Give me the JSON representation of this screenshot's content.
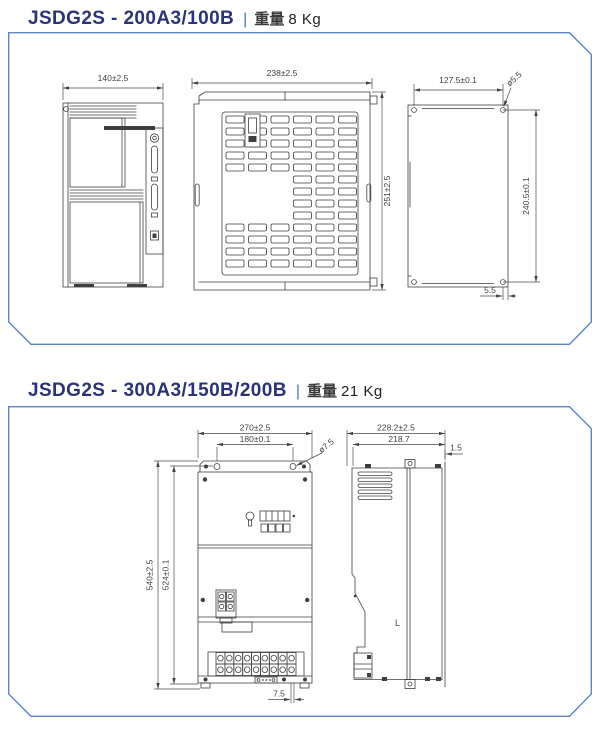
{
  "page": {
    "title_color": "#2b3377",
    "box_border_color": "#5b86c2",
    "line_color": "#3f3f3f"
  },
  "sections": [
    {
      "model": "JSDG2S - 200A3/100B",
      "separator": "|",
      "weight_label": "重量",
      "weight_value": "8 Kg",
      "dims": {
        "front_width": "140±2.5",
        "vent_width": "238±2.5",
        "vent_height": "251±2.5",
        "mount_width": "127.5±0.1",
        "mount_hole_dia": "ø5.5",
        "mount_height": "240.5±0.1",
        "mount_edge_offset": "5.5"
      }
    },
    {
      "model": "JSDG2S - 300A3/150B/200B",
      "separator": "|",
      "weight_label": "重量",
      "weight_value": "21 Kg",
      "dims": {
        "front_width": "270±2.5",
        "mount_hole_span": "180±0.1",
        "mount_hole_dia": "ø7.5",
        "front_height": "540±2.5",
        "mount_hole_height": "524±0.1",
        "bottom_offset": "7.5",
        "side_width": "228.2±2.5",
        "side_depth": "218.7",
        "flange_offset": "1.5",
        "side_mark": "L"
      }
    }
  ]
}
